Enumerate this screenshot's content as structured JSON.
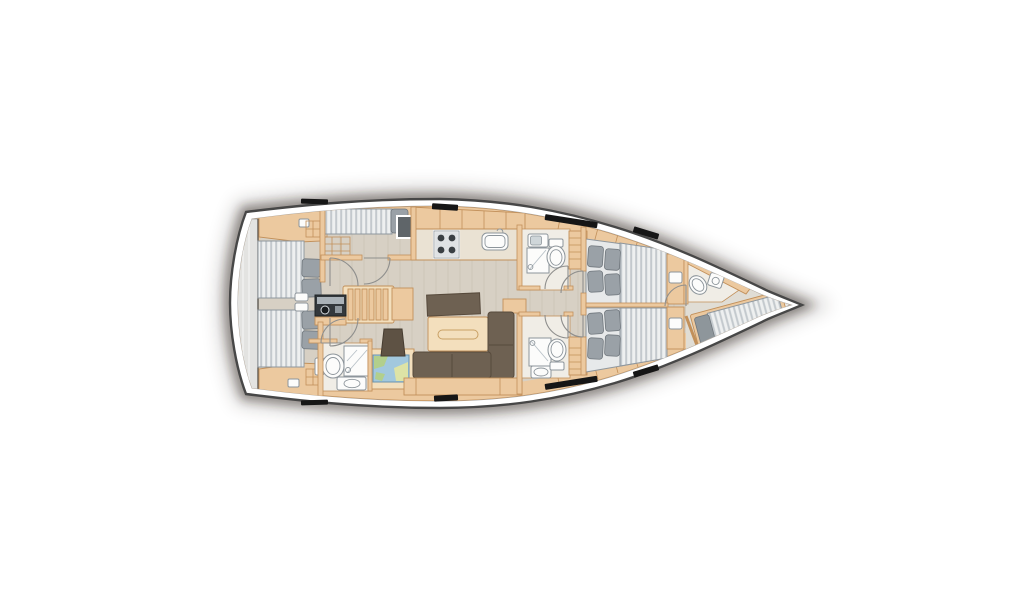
{
  "meta": {
    "diagram_type": "sailing-yacht-interior-deck-plan",
    "view": "top-down",
    "orientation": "bow-right-stern-left",
    "visible_text": ""
  },
  "colors": {
    "hull_outline": "#474747",
    "hull_inner_line": "#a8a8a8",
    "deck": "#ffffff",
    "shadow": "#261c13",
    "floor": "#d7d0c4",
    "plank": "#c8c1b3",
    "wood": "#ecc99f",
    "wood_edge": "#c2905a",
    "wood_light": "#f3dfbd",
    "counter": "#eae2d3",
    "transom": "#e3e3e1",
    "mattress": "#e7e9ea",
    "mattress_edge": "#8f979e",
    "pillow": "#9aa1a7",
    "pillow_edge": "#70777d",
    "sofa": "#6e6152",
    "sofa_edge": "#574a3c",
    "fixture_white": "#fcfcfb",
    "fixture_edge": "#8d959b",
    "shower_line": "#b9c2c8",
    "door_arc": "#8f8f8d",
    "window_black": "#161616",
    "head_floor": "#f0ede6",
    "map_water": "#a2c8de",
    "map_land": "#b2cf8c",
    "map_sand": "#dde3a6",
    "appliance_gray": "#5f6569",
    "burner_dark": "#3a3f43"
  },
  "rooms": [
    {
      "id": "stern-platform",
      "label": "stern platform / transom locker"
    },
    {
      "id": "aft-cabin-port",
      "label": "aft double cabin port",
      "furniture": [
        "double-berth",
        "pillows",
        "wardrobe-shelves"
      ]
    },
    {
      "id": "aft-cabin-starboard",
      "label": "aft double cabin starboard",
      "furniture": [
        "double-berth",
        "pillows",
        "wardrobe-shelves"
      ]
    },
    {
      "id": "side-berth-compartment",
      "label": "port side single-berth compartment",
      "furniture": [
        "single-berth",
        "pillow",
        "locker-grid"
      ]
    },
    {
      "id": "companionway",
      "label": "companionway stairs",
      "furniture": [
        "steps",
        "instrument-panel"
      ]
    },
    {
      "id": "aft-head",
      "label": "aft bathroom",
      "furniture": [
        "toilet",
        "shower",
        "washbasin"
      ]
    },
    {
      "id": "nav-station",
      "label": "chart table",
      "furniture": [
        "sea-chart",
        "navigator-stool"
      ]
    },
    {
      "id": "galley",
      "label": "galley",
      "furniture": [
        "four-burner-stove",
        "sink",
        "refrigerator",
        "overhead-lockers"
      ]
    },
    {
      "id": "salon",
      "label": "salon",
      "furniture": [
        "sideboard",
        "dining-table",
        "l-shaped-sofa",
        "cabinet"
      ]
    },
    {
      "id": "head-mid-port",
      "label": "forward bathroom port",
      "furniture": [
        "washbasin",
        "shower",
        "toilet"
      ]
    },
    {
      "id": "head-mid-starboard",
      "label": "forward bathroom starboard",
      "furniture": [
        "washbasin",
        "shower",
        "toilet"
      ]
    },
    {
      "id": "cabin-forward-port",
      "label": "forward double cabin port",
      "furniture": [
        "double-berth",
        "four-pillows",
        "shelf-ladder",
        "bedside-unit"
      ]
    },
    {
      "id": "cabin-forward-starboard",
      "label": "forward double cabin starboard",
      "furniture": [
        "double-berth",
        "four-pillows",
        "shelf-ladder",
        "bedside-unit"
      ]
    },
    {
      "id": "forepeak",
      "label": "forepeak crew cabin",
      "furniture": [
        "diagonal-single-berth",
        "pillow",
        "toilet",
        "washbasin",
        "anchor-locker"
      ]
    }
  ],
  "counts": {
    "hull_windows_top": 4,
    "hull_windows_bottom": 4,
    "door_arcs": 9
  }
}
